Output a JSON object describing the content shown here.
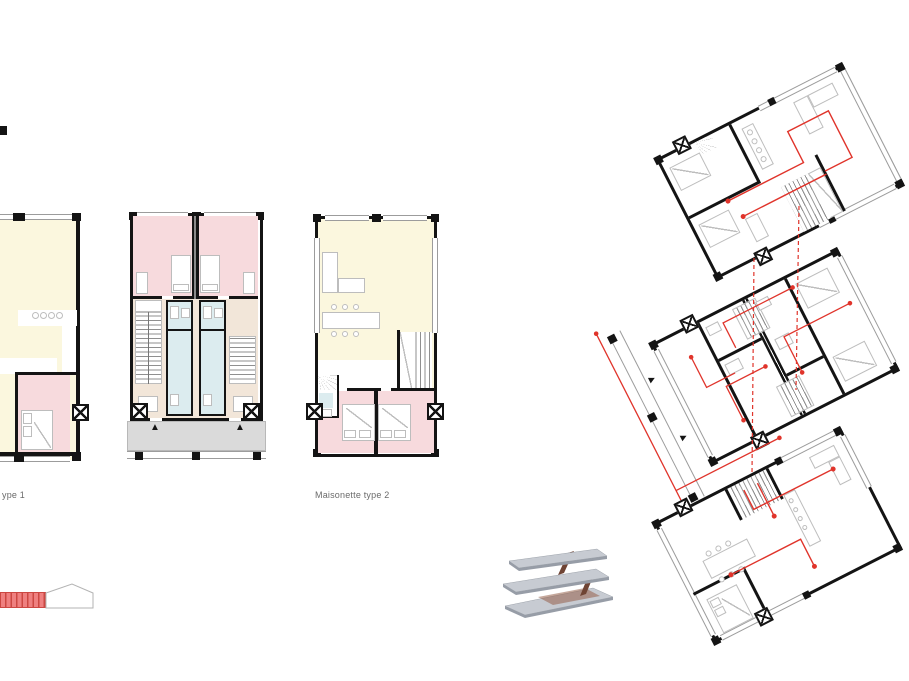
{
  "page": {
    "width": 909,
    "height": 681,
    "background": "#ffffff"
  },
  "labels": {
    "plan_type_1": "ype 1",
    "plan_type_2": "Maisonette type 2"
  },
  "glyphs": {
    "entry_arrow": "▲",
    "gallery_arrow": "▶"
  },
  "colors": {
    "wall": "#141414",
    "red": "#e0342b",
    "bedroom": "#f7dadd",
    "living": "#fbf7de",
    "circul": "#f2e6d9",
    "bath": "#dcecef",
    "terrace": "#dadada",
    "furn": "#bdbdbd",
    "winline": "#9c9c9c",
    "tread": "#8f8f8f",
    "label": "#6b6b6b",
    "stairred": "#ef8080",
    "stairredline": "#cc4843",
    "axonslab": "#c7cbd2",
    "axonedge": "#979da7",
    "axonstair": "#6f4434",
    "axonbrown": "#96604a"
  },
  "drawing": {
    "left_plans": [
      "maisonette-type-1-cropped",
      "duplex-pair-entrance-level",
      "maisonette-type-2"
    ],
    "right_stack_floors": 3,
    "annotations": [
      "red-circulation-routes",
      "red-dashed-stair-links"
    ],
    "symbols": [
      "shaft-x",
      "entry-arrow",
      "red-stair-section",
      "stacked-slab-axonometric"
    ]
  }
}
